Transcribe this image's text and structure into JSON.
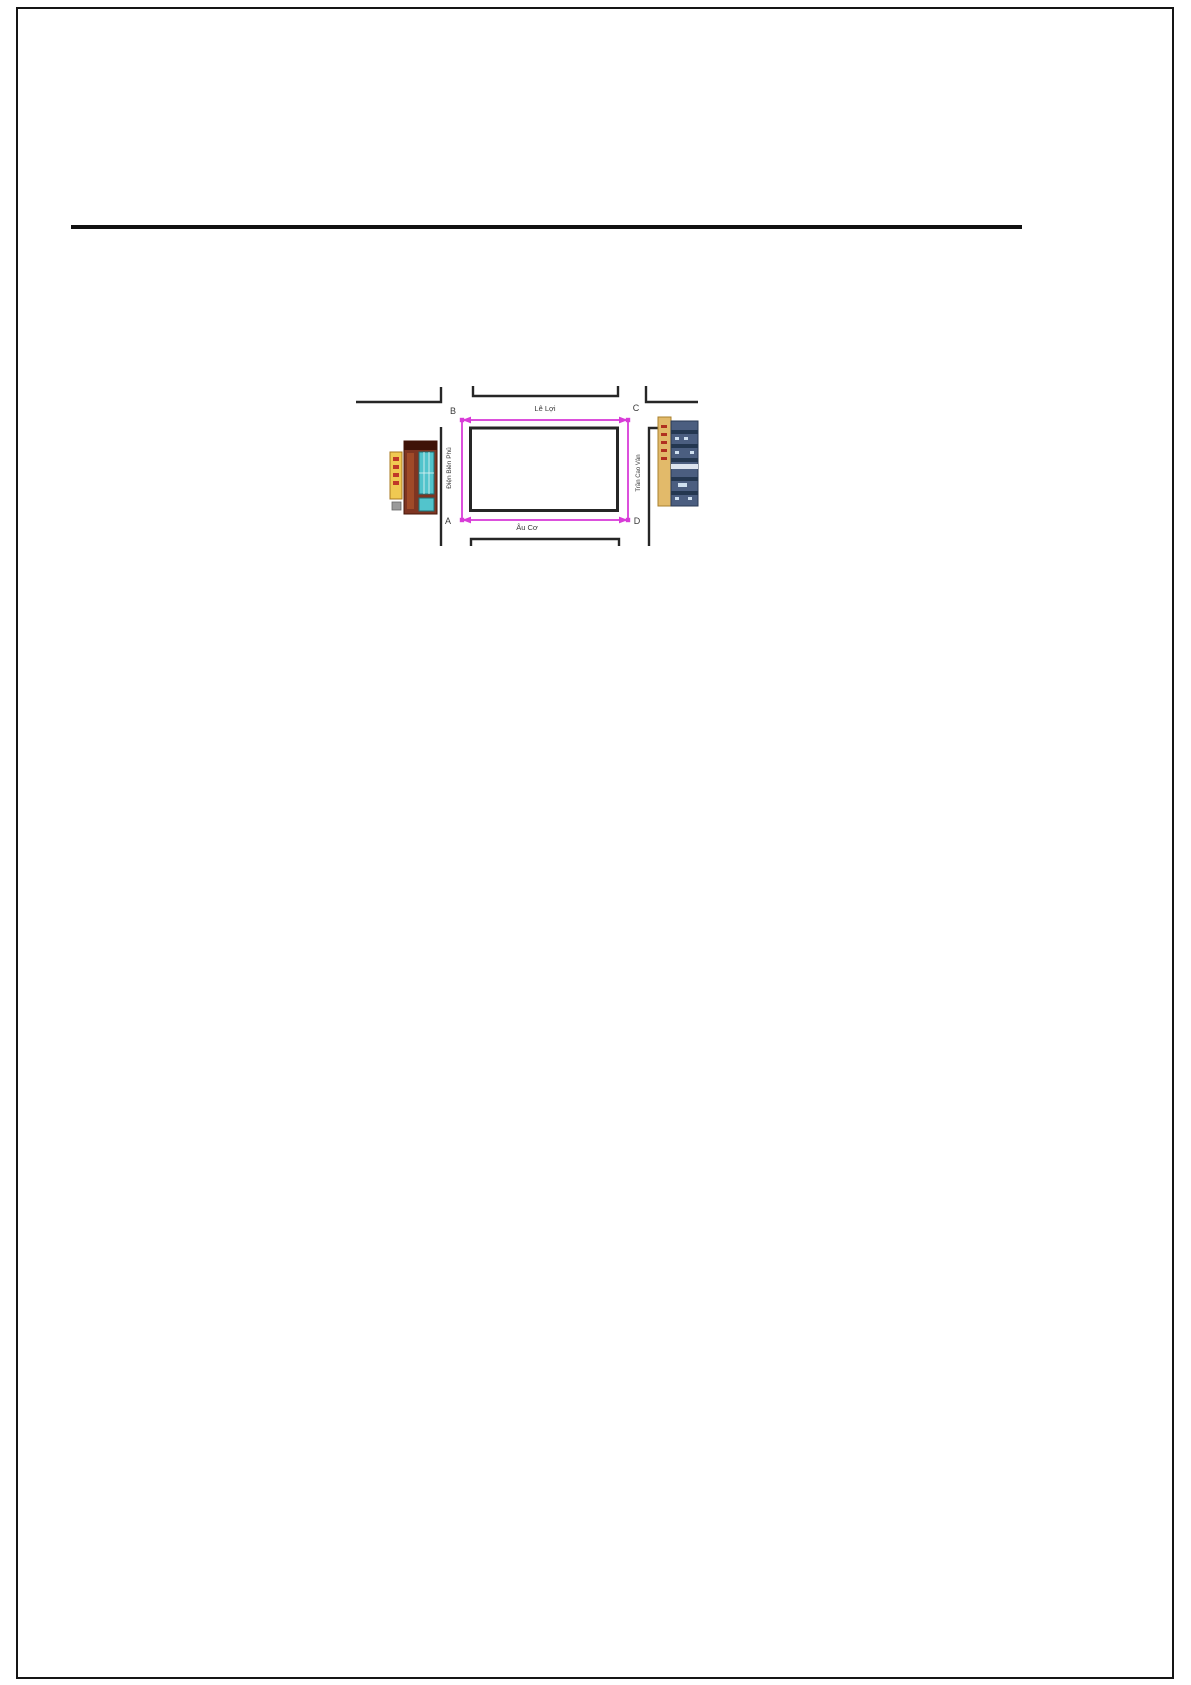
{
  "document": {
    "figure": {
      "description_labels": {
        "corner_top_left": "B",
        "corner_top_right": "C",
        "corner_bottom_left": "A",
        "corner_bottom_right": "D"
      },
      "streets": {
        "top": "Lê Lợi",
        "bottom": "Âu Cơ",
        "left": "Điện Biên Phủ",
        "right": "Trần Cao Vân"
      },
      "landmarks": {
        "left": "shop-storefront",
        "right": "apartment-block"
      },
      "colors": {
        "route_highlight": "#d83cd8",
        "street_line": "#262626",
        "page_border": "#151515",
        "shop_sign": "#f0c952",
        "shop_facade": "#7e3522",
        "shop_glass": "#52c4cc",
        "apartment_wall": "#4b5e80",
        "apartment_sign": "#e2ba6a"
      }
    }
  }
}
